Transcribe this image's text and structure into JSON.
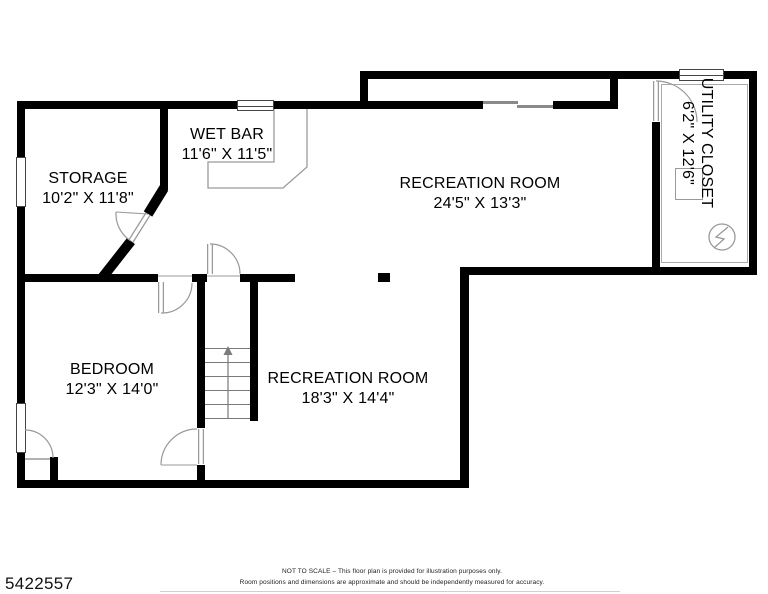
{
  "floorplan": {
    "rooms": [
      {
        "name": "STORAGE",
        "dims": "10'2\" X 11'8\""
      },
      {
        "name": "WET BAR",
        "dims": "11'6\" X 11'5\""
      },
      {
        "name": "RECREATION ROOM",
        "dims": "24'5\" X 13'3\""
      },
      {
        "name": "UTILITY CLOSET",
        "dims": "6'2\" X 12'6\""
      },
      {
        "name": "BEDROOM",
        "dims": "12'3\" X 14'0\""
      },
      {
        "name": "RECREATION ROOM",
        "dims": "18'3\" X 14'4\""
      }
    ],
    "symbols": {
      "stairs_direction": "up",
      "electrical_panel": "circle-with-lightning-bolt"
    },
    "colors": {
      "wall": "#000000",
      "thin_line": "#999999",
      "text": "#000000"
    },
    "footer": {
      "listing_id": "5422557",
      "disclaimer_line1": "NOT TO SCALE – This floor plan is provided for illustration purposes only.",
      "disclaimer_line2": "Room positions and dimensions are approximate and should be independently measured for accuracy."
    }
  }
}
